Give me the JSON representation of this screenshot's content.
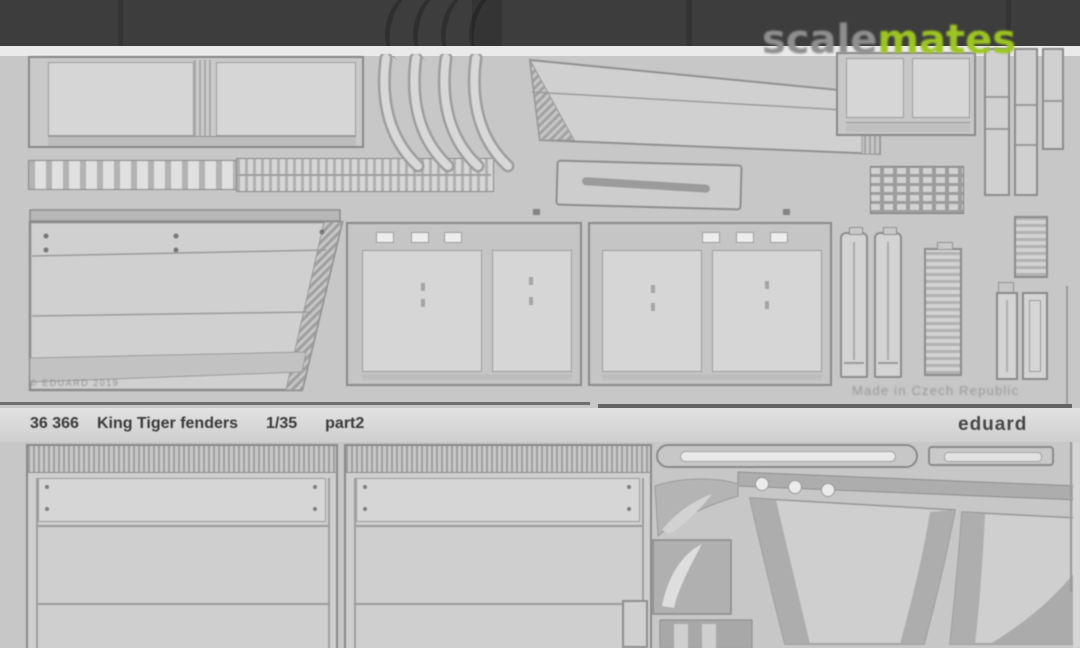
{
  "watermark": {
    "gray_part": "scale",
    "green_part": "mates"
  },
  "sheet_top": {
    "copyright": "© EDUARD 2019",
    "made_in": "Made in Czech Republic"
  },
  "label": {
    "code": "36 366",
    "name": "King Tiger fenders",
    "scale": "1/35",
    "part": "part2",
    "brand": "eduard"
  },
  "colors": {
    "scalemates_green": "#9dc522",
    "scalemates_gray": "#8f8f8f",
    "top_band": "#3d3d3d",
    "sheet_background": "#c7c7c7",
    "part_fill": "#d2d2d2",
    "part_outline": "#8a8a8a",
    "label_text": "#3a3a3a"
  }
}
